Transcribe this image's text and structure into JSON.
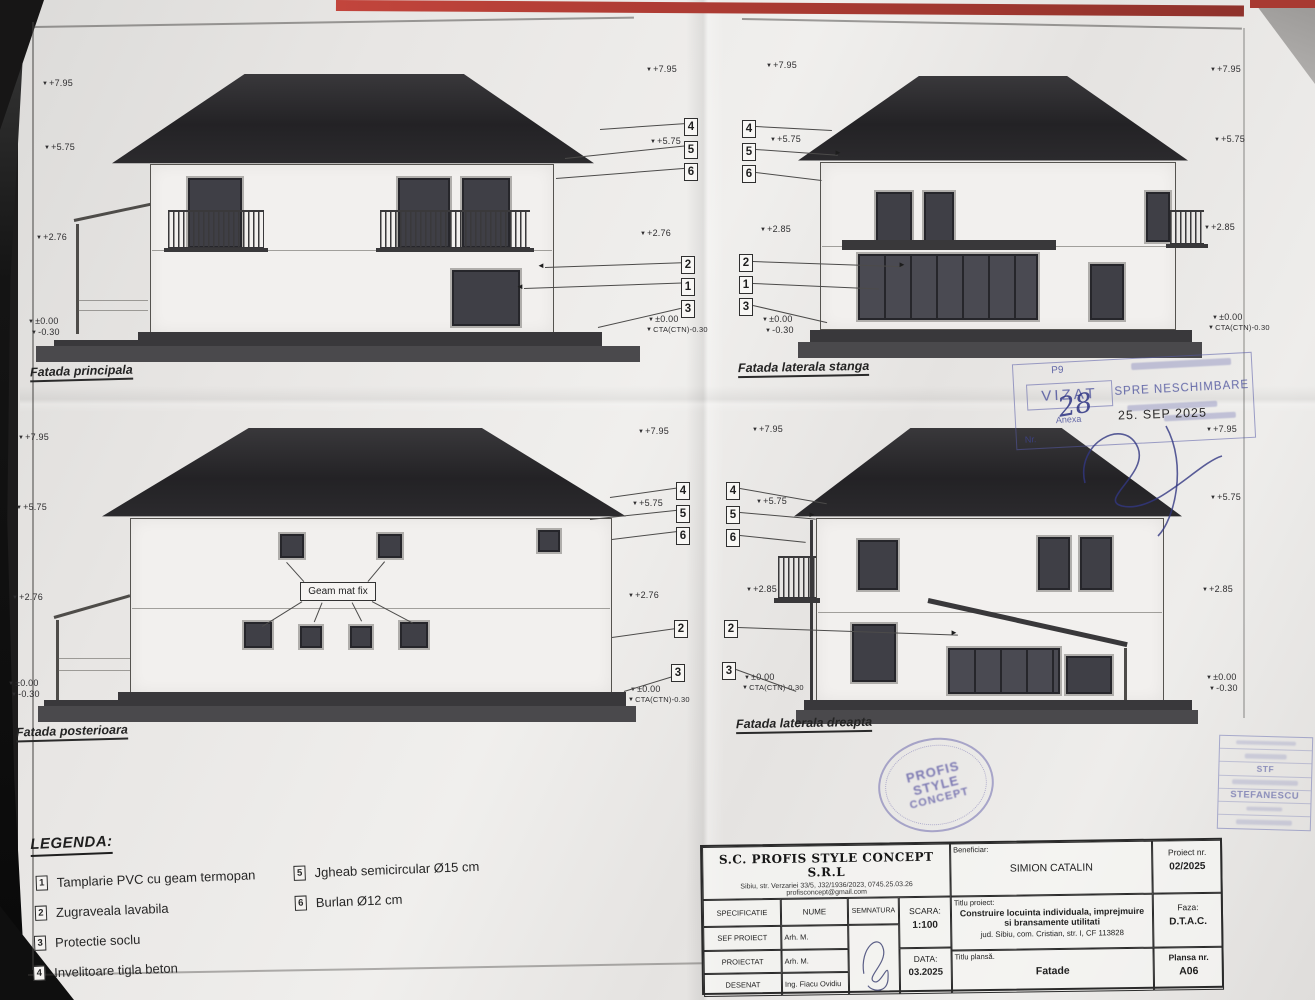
{
  "colors": {
    "backing_red": "#b8423a",
    "backing_dark": "#161616",
    "paper": "#eceae7",
    "ink": "#2e2d2f",
    "stamp_blue": "#5c60a8"
  },
  "levels": {
    "ridge": "+7.95",
    "eaves": "+5.75",
    "etaj_276": "+2.76",
    "etaj_285": "+2.85",
    "zero": "±0.00",
    "teren": "-0.30",
    "cta": "CTA(CTN)-0.30"
  },
  "callouts": {
    "1": "1",
    "2": "2",
    "3": "3",
    "4": "4",
    "5": "5",
    "6": "6"
  },
  "facades": {
    "principala": {
      "title": "Fatada principala"
    },
    "stanga": {
      "title": "Fatada laterala stanga"
    },
    "posterioara": {
      "title": "Fatada posterioara",
      "note": "Geam mat fix"
    },
    "dreapta": {
      "title": "Fatada laterala dreapta"
    }
  },
  "legend": {
    "title": "LEGENDA:",
    "items": [
      {
        "num": "1",
        "text": "Tamplarie PVC cu geam termopan"
      },
      {
        "num": "2",
        "text": "Zugraveala lavabila"
      },
      {
        "num": "3",
        "text": "Protectie soclu"
      },
      {
        "num": "4",
        "text": "Invelitoare tigla beton"
      },
      {
        "num": "5",
        "text": "Jgheab semicircular Ø15 cm"
      },
      {
        "num": "6",
        "text": "Burlan Ø12 cm"
      }
    ]
  },
  "titleblock": {
    "company": "S.C. PROFIS STYLE CONCEPT S.R.L",
    "address": "Sibiu, str. Verzariei 33/5, J32/1936/2023, 0745.25.03.26",
    "email": "profisconcept@gmail.com",
    "beneficiar_label": "Beneficiar:",
    "beneficiar": "SIMION CATALIN",
    "proiect_nr_label": "Proiect nr.",
    "proiect_nr": "02/2025",
    "spec_header": "SPECIFICATIE",
    "nume_header": "NUME",
    "semnatura_header": "SEMNATURA",
    "scara_label": "SCARA:",
    "scara": "1:100",
    "data_label": "DATA:",
    "data": "03.2025",
    "rows": [
      {
        "spec": "SEF PROIECT",
        "nume": "Arh. M. Stefanescu"
      },
      {
        "spec": "PROIECTAT",
        "nume": "Arh. M. Stefanescu"
      },
      {
        "spec": "DESENAT",
        "nume": "Ing. Fiacu Ovidiu"
      }
    ],
    "titlu_proiect_label": "Titlu proiect:",
    "titlu_proiect": "Construire locuinta individuala, imprejmuire si bransamente utilitati",
    "titlu_proiect_loc": "jud. Sibiu, com. Cristian, str. I, CF 113828",
    "faza_label": "Faza:",
    "faza": "D.T.A.C.",
    "titlu_plansa_label": "Titlu plansă.",
    "titlu_plansa": "Fatade",
    "plansa_nr_label": "Plansa nr.",
    "plansa_nr": "A06"
  },
  "stamps": {
    "vizat": {
      "top": "P9",
      "title": "VIZAT",
      "sub": "Anexa",
      "nr_label": "Nr.",
      "number": "28"
    },
    "neschimbare": {
      "title": "SPRE NESCHIMBARE",
      "date": "25. SEP 2025"
    },
    "round": {
      "line1": "PROFIS",
      "line2": "STYLE",
      "line3": "CONCEPT"
    },
    "corner": {
      "line1": "STF",
      "line2": "STEFANESCU"
    }
  }
}
